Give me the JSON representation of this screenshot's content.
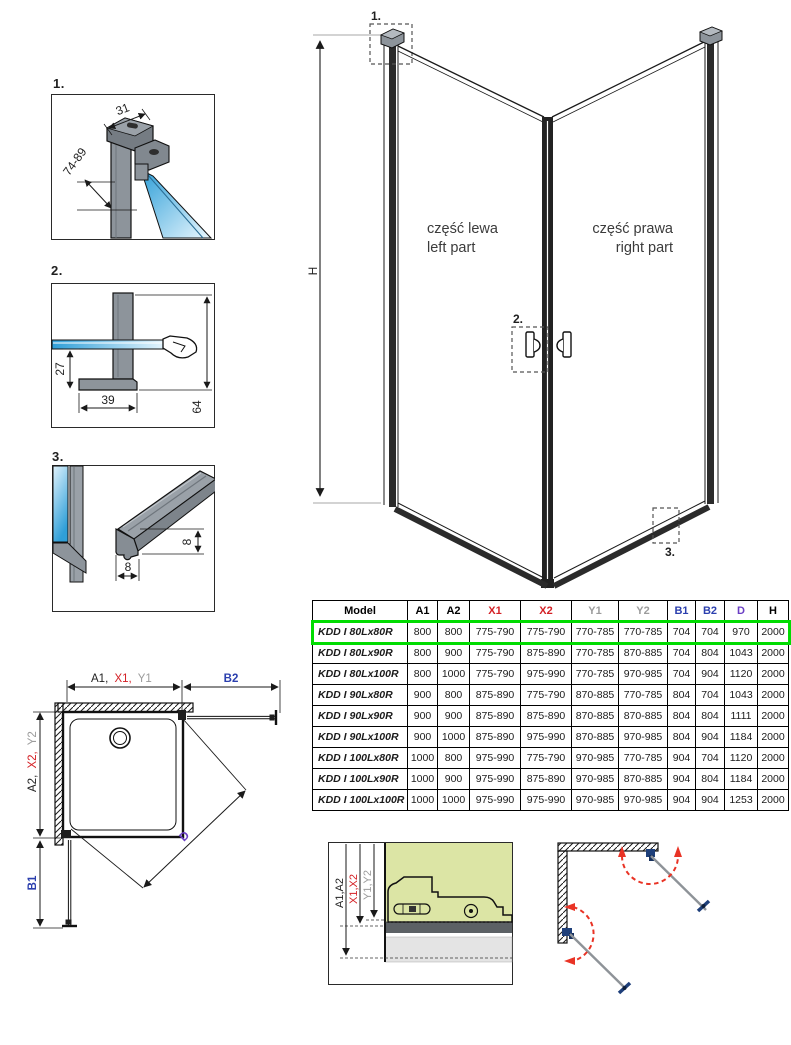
{
  "colors": {
    "dim_red": "#D42025",
    "dim_gray": "#9C9C9C",
    "dim_blue": "#2B3FAE",
    "dim_purple": "#6B3FC4",
    "highlight_green": "#00DC00",
    "glass_blue": "#2F9FD8",
    "profile_gray": "#8D949B",
    "swing_red": "#E93325",
    "hinge_blue": "#1E3F7A",
    "section_green": "#DCE5A5",
    "line_dark": "#1A1A1A"
  },
  "details": {
    "d1": {
      "label": "1.",
      "dim_width": "31",
      "dim_range": "74-89"
    },
    "d2": {
      "label": "2.",
      "dim_offset": "27",
      "dim_width": "39",
      "dim_height": "64"
    },
    "d3": {
      "label": "3.",
      "dim_v": "8",
      "dim_h": "8"
    }
  },
  "main_drawing": {
    "height_label": "H",
    "callout_1": "1.",
    "callout_2": "2.",
    "callout_3": "3.",
    "left_part": {
      "line1": "część lewa",
      "line2": "left part"
    },
    "right_part": {
      "line1": "część prawa",
      "line2": "right part"
    }
  },
  "table": {
    "headers": [
      {
        "label": "Model",
        "color": "#000000"
      },
      {
        "label": "A1",
        "color": "#000000"
      },
      {
        "label": "A2",
        "color": "#000000"
      },
      {
        "label": "X1",
        "color": "#D42025"
      },
      {
        "label": "X2",
        "color": "#D42025"
      },
      {
        "label": "Y1",
        "color": "#9C9C9C"
      },
      {
        "label": "Y2",
        "color": "#9C9C9C"
      },
      {
        "label": "B1",
        "color": "#2B3FAE"
      },
      {
        "label": "B2",
        "color": "#2B3FAE"
      },
      {
        "label": "D",
        "color": "#6B3FC4"
      },
      {
        "label": "H",
        "color": "#000000"
      }
    ],
    "rows": [
      {
        "model": "KDD I 80Lx80R",
        "values": [
          "800",
          "800",
          "775-790",
          "775-790",
          "770-785",
          "770-785",
          "704",
          "704",
          "970",
          "2000"
        ],
        "highlighted": true
      },
      {
        "model": "KDD I 80Lx90R",
        "values": [
          "800",
          "900",
          "775-790",
          "875-890",
          "770-785",
          "870-885",
          "704",
          "804",
          "1043",
          "2000"
        ],
        "highlighted": false
      },
      {
        "model": "KDD I 80Lx100R",
        "values": [
          "800",
          "1000",
          "775-790",
          "975-990",
          "770-785",
          "970-985",
          "704",
          "904",
          "1120",
          "2000"
        ],
        "highlighted": false
      },
      {
        "model": "KDD I 90Lx80R",
        "values": [
          "900",
          "800",
          "875-890",
          "775-790",
          "870-885",
          "770-785",
          "804",
          "704",
          "1043",
          "2000"
        ],
        "highlighted": false
      },
      {
        "model": "KDD I 90Lx90R",
        "values": [
          "900",
          "900",
          "875-890",
          "875-890",
          "870-885",
          "870-885",
          "804",
          "804",
          "1111",
          "2000"
        ],
        "highlighted": false
      },
      {
        "model": "KDD I 90Lx100R",
        "values": [
          "900",
          "1000",
          "875-890",
          "975-990",
          "870-885",
          "970-985",
          "804",
          "904",
          "1184",
          "2000"
        ],
        "highlighted": false
      },
      {
        "model": "KDD I 100Lx80R",
        "values": [
          "1000",
          "800",
          "975-990",
          "775-790",
          "970-985",
          "770-785",
          "904",
          "704",
          "1120",
          "2000"
        ],
        "highlighted": false
      },
      {
        "model": "KDD I 100Lx90R",
        "values": [
          "1000",
          "900",
          "975-990",
          "875-890",
          "970-985",
          "870-885",
          "904",
          "804",
          "1184",
          "2000"
        ],
        "highlighted": false
      },
      {
        "model": "KDD I 100Lx100R",
        "values": [
          "1000",
          "1000",
          "975-990",
          "975-990",
          "970-985",
          "970-985",
          "904",
          "904",
          "1253",
          "2000"
        ],
        "highlighted": false
      }
    ]
  },
  "plan_view": {
    "dim_top_a": "A1,",
    "dim_top_x": "X1,",
    "dim_top_y": "Y1",
    "dim_b2": "B2",
    "dim_left_a": "A2,",
    "dim_left_x": "X2,",
    "dim_left_y": "Y2",
    "dim_b1": "B1",
    "dim_d": "D"
  },
  "section_view": {
    "dim_a": "A1,A2",
    "dim_x": "X1,X2",
    "dim_y": "Y1,Y2"
  }
}
